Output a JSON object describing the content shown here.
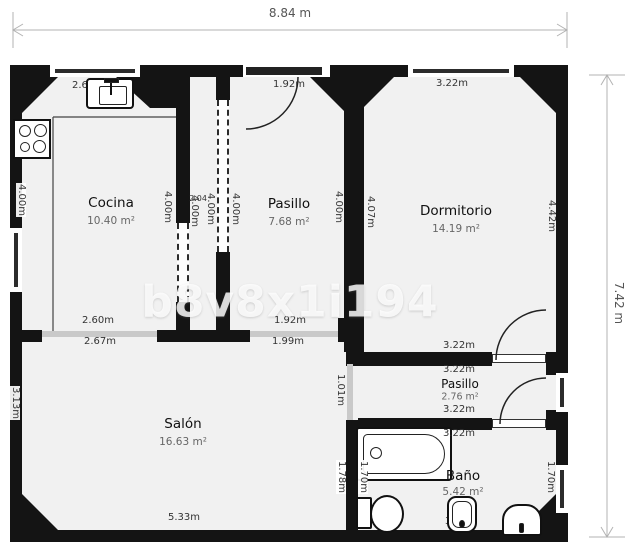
{
  "watermark": "b8v8x1i194",
  "overall_dimensions": {
    "width": "8.84 m",
    "height": "7.42 m"
  },
  "rooms": {
    "cocina": {
      "name": "Cocina",
      "area": "10.40 m²"
    },
    "pasillo": {
      "name": "Pasillo",
      "area": "7.68 m²"
    },
    "dormitorio": {
      "name": "Dormitorio",
      "area": "14.19 m²"
    },
    "salon": {
      "name": "Salón",
      "area": "16.63 m²"
    },
    "pasillo2": {
      "name": "Pasillo",
      "area": "2.76 m²"
    },
    "bano": {
      "name": "Baño",
      "area": "5.42 m²"
    }
  },
  "dims": {
    "kitchen_window": "2.60m",
    "entry": "1.92m",
    "dorm_window": "3.22m",
    "left_kitchen": "4.00m",
    "divider_a": "4.00m",
    "divider_b": "4.00m",
    "divider_small": "2.04",
    "divider_c": "4.00m",
    "divider_d": "4.00m",
    "pasillo_right": "4.00m",
    "dorm_left": "4.07m",
    "dorm_right": "4.42m",
    "kitchen_opening_top": "2.60m",
    "kitchen_opening_bottom": "2.67m",
    "salon_opening_top": "1.92m",
    "salon_opening_bottom": "1.99m",
    "dorm_bottom_above": "3.22m",
    "dorm_bottom_below": "3.22m",
    "pasillo2_above": "3.22m",
    "pasillo2_below": "3.22m",
    "bano_bottom": "3.22m",
    "salon_bottom": "5.33m",
    "salon_opening_vertical": "1.01m",
    "salon_left": "3.13m",
    "salon_bano": "1.78m",
    "bathtub": "1.70m",
    "bano_window": "1.70m"
  }
}
